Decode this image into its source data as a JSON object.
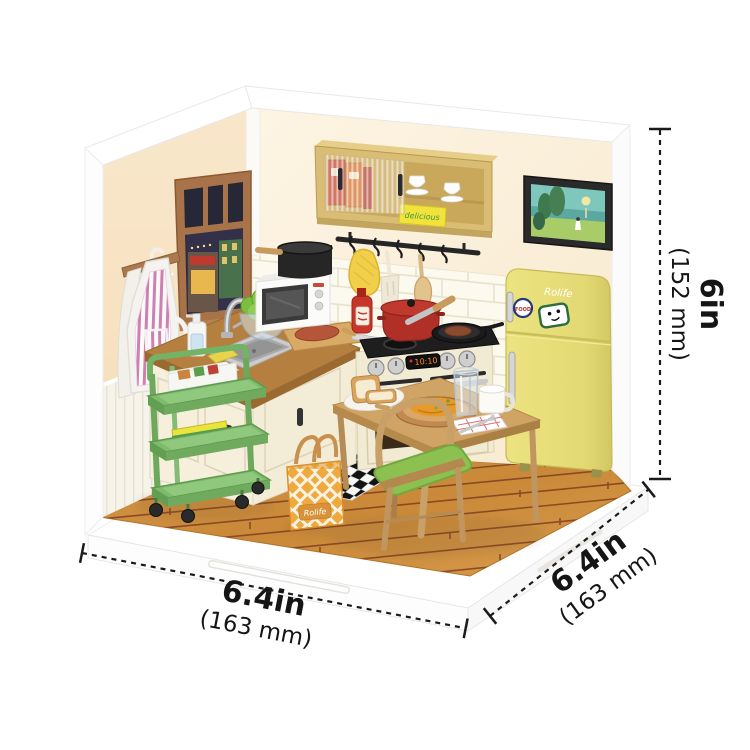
{
  "product_image": {
    "dimensions": {
      "height": {
        "inches": "6in",
        "millimeters": "(152 mm)"
      },
      "width": {
        "inches": "6.4in",
        "millimeters": "(163 mm)"
      },
      "depth": {
        "inches": "6.4in",
        "millimeters": "(163 mm)"
      }
    },
    "branding": {
      "fridge_logo": "Rolife",
      "bag_label": "Rolife",
      "fridge_sticker_text": "FOOD",
      "cabinet_box_text": "delicious",
      "stove_display": "10:10"
    },
    "colors": {
      "background": "#ffffff",
      "left_wall": "#f8e3c3",
      "right_wall": "#fdf2de",
      "floor_wood": "#cd8c3e",
      "fridge_yellow": "#e9e07d",
      "cart_green": "#7fbb6d",
      "cabinet_tan": "#d9bd74",
      "bag_orange": "#f0a93c",
      "pot_red": "#b5312c",
      "chair_cushion_green": "#8cc152",
      "dimension_line": "#1a1a1a"
    }
  }
}
